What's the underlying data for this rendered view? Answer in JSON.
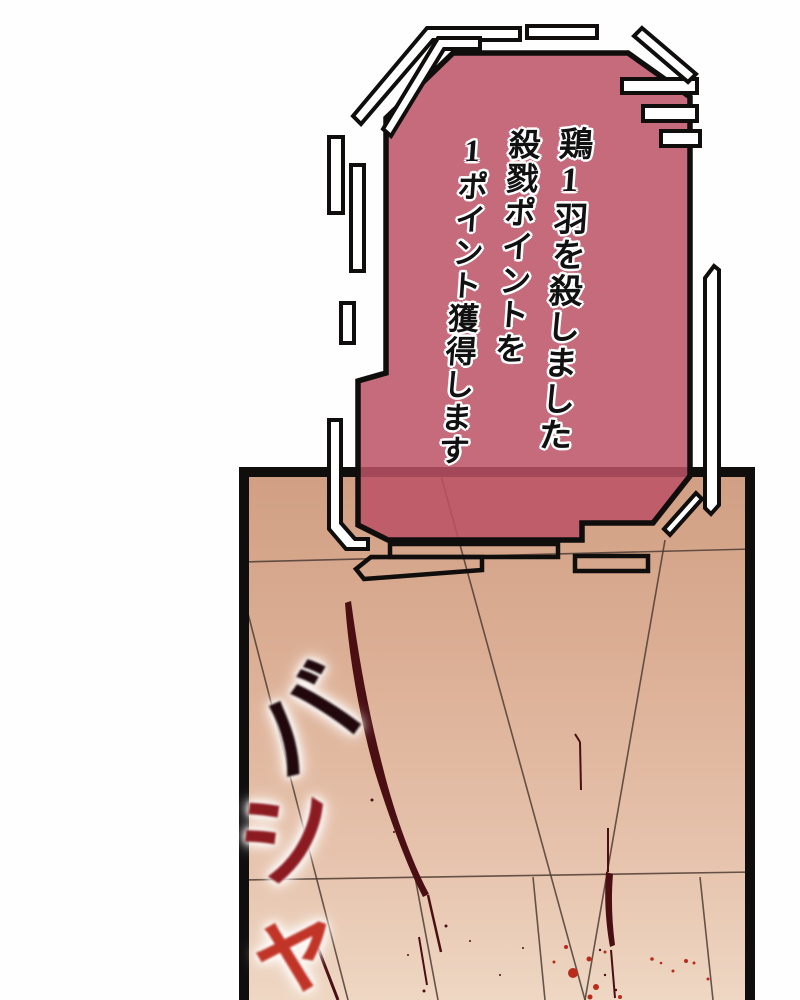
{
  "notification": {
    "lines": [
      "鶏1羽を殺しました",
      "殺戮ポイントを",
      "1ポイント獲得します"
    ]
  },
  "sfx": {
    "chars": [
      "バ",
      "シ",
      "ャ"
    ]
  },
  "colors": {
    "bg": "#fefefe",
    "ink": "#100d0d",
    "box-pink": "#bc5365",
    "floor-top": "#d09e82",
    "floor-mid": "#dfb59b",
    "floor-bottom": "#eed7c3",
    "floor-line": "#4e3c34",
    "blood-dark": "#4a0f13",
    "blood-bright": "#b92b1b",
    "sfx-ba": "#20080c",
    "sfx-shi": "#8c1b21",
    "sfx-ya": "#c13528",
    "text": "#111111",
    "text-outline": "#ffffff"
  }
}
